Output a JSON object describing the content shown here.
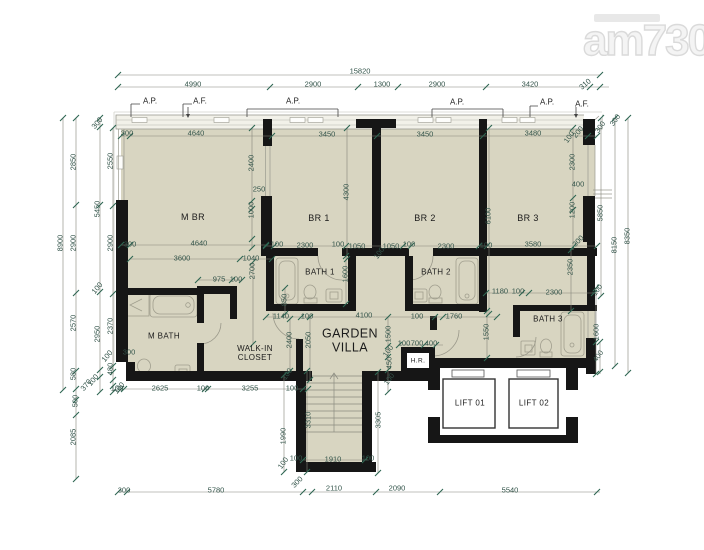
{
  "watermark": {
    "text": "am730"
  },
  "colors": {
    "floor": "#d8d5c1",
    "wall": "#161616",
    "dim_text": "#33544a",
    "logo": "#e4e4e4"
  },
  "rooms": [
    {
      "id": "m-br",
      "label": "M BR",
      "x": 193,
      "y": 217,
      "fs": 9
    },
    {
      "id": "br-1",
      "label": "BR 1",
      "x": 319,
      "y": 218,
      "fs": 9
    },
    {
      "id": "br-2",
      "label": "BR 2",
      "x": 425,
      "y": 218,
      "fs": 9
    },
    {
      "id": "br-3",
      "label": "BR 3",
      "x": 528,
      "y": 218,
      "fs": 9
    },
    {
      "id": "bath-1",
      "label": "BATH 1",
      "x": 320,
      "y": 272,
      "fs": 8
    },
    {
      "id": "bath-2",
      "label": "BATH 2",
      "x": 436,
      "y": 272,
      "fs": 8
    },
    {
      "id": "bath-3",
      "label": "BATH 3",
      "x": 548,
      "y": 319,
      "fs": 8
    },
    {
      "id": "m-bath",
      "label": "M BATH",
      "x": 164,
      "y": 336,
      "fs": 8
    },
    {
      "id": "walk-in-closet",
      "label": "WALK-IN\nCLOSET",
      "x": 255,
      "y": 353,
      "fs": 8
    },
    {
      "id": "garden-villa",
      "label": "GARDEN\nVILLA",
      "x": 350,
      "y": 341,
      "fs": 12.5
    },
    {
      "id": "hr",
      "label": "H.R.",
      "x": 418,
      "y": 361,
      "fs": 6.5
    },
    {
      "id": "lift-01",
      "label": "LIFT 01",
      "x": 470,
      "y": 403,
      "fs": 8
    },
    {
      "id": "lift-02",
      "label": "LIFT 02",
      "x": 534,
      "y": 403,
      "fs": 8
    }
  ],
  "markers": [
    {
      "label": "A.P.",
      "x": 150,
      "y": 101
    },
    {
      "label": "A.F.",
      "x": 200,
      "y": 101
    },
    {
      "label": "A.P.",
      "x": 293,
      "y": 101
    },
    {
      "label": "A.P.",
      "x": 457,
      "y": 102
    },
    {
      "label": "A.P.",
      "x": 547,
      "y": 102
    },
    {
      "label": "A.F.",
      "x": 582,
      "y": 104
    }
  ],
  "dims": [
    [
      "15820",
      360,
      71,
      0
    ],
    [
      "4990",
      193,
      84,
      0
    ],
    [
      "2900",
      313,
      84,
      0
    ],
    [
      "1300",
      382,
      84,
      0
    ],
    [
      "2900",
      437,
      84,
      0
    ],
    [
      "3420",
      530,
      84,
      0
    ],
    [
      "310",
      585,
      84,
      -40
    ],
    [
      "300",
      127,
      133,
      0
    ],
    [
      "4640",
      196,
      133,
      0
    ],
    [
      "3450",
      327,
      134,
      0
    ],
    [
      "3450",
      425,
      134,
      0
    ],
    [
      "3480",
      533,
      133,
      0
    ],
    [
      "100",
      569,
      137,
      -55
    ],
    [
      "200",
      578,
      132,
      -50
    ],
    [
      "300",
      600,
      127,
      -55
    ],
    [
      "300",
      615,
      120,
      -55
    ],
    [
      "8900",
      60,
      243,
      -90
    ],
    [
      "2850",
      73,
      162,
      -90
    ],
    [
      "2900",
      73,
      243,
      -90
    ],
    [
      "2570",
      73,
      323,
      -90
    ],
    [
      "580",
      73,
      374,
      -90
    ],
    [
      "370",
      86,
      385,
      -50
    ],
    [
      "500",
      75,
      401,
      -90
    ],
    [
      "2085",
      73,
      437,
      -90
    ],
    [
      "300",
      97,
      123,
      -50
    ],
    [
      "2550",
      110,
      161,
      -90
    ],
    [
      "5450",
      97,
      209,
      -90
    ],
    [
      "2900",
      110,
      243,
      -90
    ],
    [
      "100",
      97,
      288,
      -50
    ],
    [
      "2950",
      97,
      334,
      -90
    ],
    [
      "2370",
      110,
      326,
      -90
    ],
    [
      "100",
      107,
      356,
      -50
    ],
    [
      "480",
      110,
      369,
      -90
    ],
    [
      "100",
      93,
      380,
      -50
    ],
    [
      "100",
      119,
      388,
      -50
    ],
    [
      "2300",
      572,
      162,
      -90
    ],
    [
      "400",
      578,
      184,
      0
    ],
    [
      "1200",
      572,
      210,
      -90
    ],
    [
      "300",
      578,
      241,
      -45
    ],
    [
      "5850",
      600,
      213,
      -90
    ],
    [
      "8150",
      614,
      245,
      -90
    ],
    [
      "8350",
      627,
      236,
      -90
    ],
    [
      "100",
      597,
      290,
      -55
    ],
    [
      "1600",
      596,
      332,
      -90
    ],
    [
      "400",
      598,
      356,
      -55
    ],
    [
      "2400",
      251,
      163,
      -90
    ],
    [
      "250",
      259,
      189,
      0
    ],
    [
      "1000",
      251,
      210,
      -90
    ],
    [
      "300",
      130,
      244,
      0
    ],
    [
      "4640",
      199,
      243,
      0
    ],
    [
      "3600",
      182,
      258,
      0
    ],
    [
      "1040",
      251,
      258,
      0
    ],
    [
      "975",
      219,
      279,
      0
    ],
    [
      "100",
      236,
      279,
      0
    ],
    [
      "2700",
      252,
      271,
      -90
    ],
    [
      "850",
      284,
      300,
      -90
    ],
    [
      "4300",
      346,
      192,
      -90
    ],
    [
      "6100",
      488,
      216,
      -90
    ],
    [
      "100",
      277,
      244,
      0
    ],
    [
      "2300",
      305,
      245,
      0
    ],
    [
      "100",
      338,
      244,
      0
    ],
    [
      "1050",
      357,
      246,
      0
    ],
    [
      "1050",
      391,
      246,
      0
    ],
    [
      "100",
      409,
      244,
      0
    ],
    [
      "2300",
      446,
      246,
      0
    ],
    [
      "100",
      486,
      245,
      0
    ],
    [
      "3580",
      533,
      244,
      0
    ],
    [
      "100",
      379,
      253,
      -55
    ],
    [
      "1600",
      345,
      274,
      -90
    ],
    [
      "1140",
      281,
      316,
      0
    ],
    [
      "100",
      307,
      316,
      0
    ],
    [
      "4100",
      364,
      315,
      0
    ],
    [
      "100",
      417,
      316,
      0
    ],
    [
      "1760",
      454,
      316,
      0
    ],
    [
      "2400",
      289,
      340,
      -90
    ],
    [
      "2050",
      308,
      340,
      -90
    ],
    [
      "1500",
      388,
      334,
      -90
    ],
    [
      "100",
      388,
      351,
      -55
    ],
    [
      "450",
      389,
      363,
      -90
    ],
    [
      "100",
      389,
      379,
      -55
    ],
    [
      "100",
      404,
      343,
      0
    ],
    [
      "700",
      417,
      343,
      0
    ],
    [
      "400",
      431,
      343,
      0
    ],
    [
      "1180",
      500,
      291,
      0
    ],
    [
      "100",
      518,
      291,
      0
    ],
    [
      "2300",
      554,
      292,
      0
    ],
    [
      "2350",
      570,
      267,
      -90
    ],
    [
      "1550",
      486,
      332,
      -90
    ],
    [
      "300",
      129,
      352,
      0
    ],
    [
      "100",
      117,
      388,
      0
    ],
    [
      "2625",
      160,
      388,
      0
    ],
    [
      "100",
      203,
      388,
      0
    ],
    [
      "3255",
      250,
      388,
      0
    ],
    [
      "100",
      292,
      388,
      0
    ],
    [
      "100",
      287,
      374,
      -55
    ],
    [
      "3310",
      308,
      420,
      -90
    ],
    [
      "3305",
      378,
      420,
      -90
    ],
    [
      "1990",
      283,
      436,
      -90
    ],
    [
      "100",
      283,
      463,
      -55
    ],
    [
      "100",
      296,
      458,
      0
    ],
    [
      "1910",
      333,
      459,
      0
    ],
    [
      "100",
      368,
      458,
      0
    ],
    [
      "300",
      297,
      482,
      -45
    ],
    [
      "300",
      124,
      490,
      0
    ],
    [
      "5780",
      216,
      490,
      0
    ],
    [
      "2110",
      334,
      488,
      0
    ],
    [
      "2090",
      397,
      488,
      0
    ],
    [
      "5540",
      510,
      490,
      0
    ]
  ]
}
